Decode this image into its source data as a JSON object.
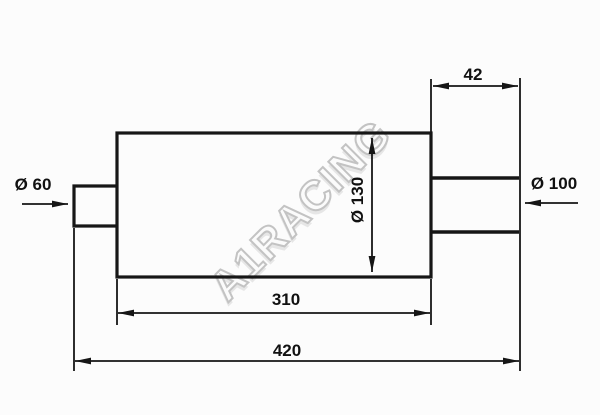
{
  "drawing": {
    "watermark_text": "A1RACING",
    "labels": {
      "inlet_diameter": "Ø 60",
      "outlet_diameter": "Ø 100",
      "body_diameter": "Ø 130",
      "outlet_stub_length": "42",
      "body_length": "310",
      "overall_length": "420"
    },
    "colors": {
      "line": "#161616",
      "text": "#111111",
      "watermark_outline": "#c3c3c3",
      "background": "#fcfcfc"
    }
  }
}
